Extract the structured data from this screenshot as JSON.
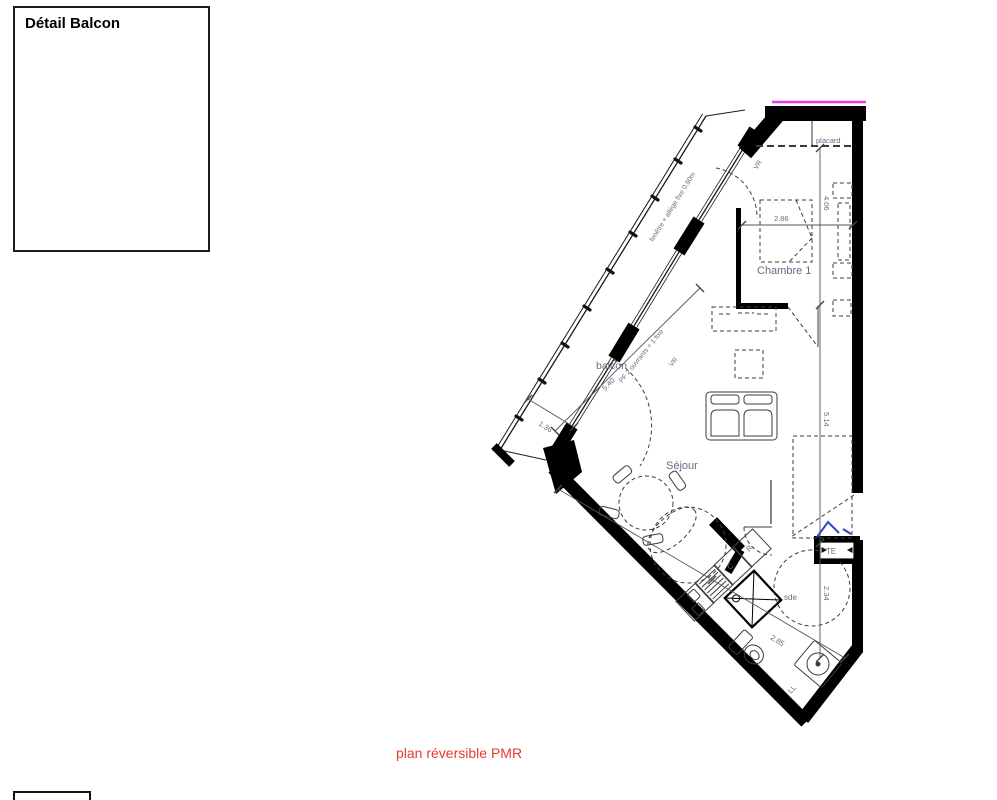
{
  "detail_box": {
    "title": "Détail Balcon"
  },
  "caption": {
    "text": "plan réversible PMR",
    "color": "#e53935"
  },
  "plan": {
    "rooms": {
      "balcony": "balcon",
      "living": "Séjour",
      "bedroom": "Chambre 1",
      "closet": "placard",
      "bathroom": "sde"
    },
    "annotations": {
      "window_note": "fenêtre + allège fixe 0.90m",
      "balcony_door_note": "PF 2 ouvrants + 1 fixe",
      "shutter_top": "VR",
      "shutter_mid": "VR",
      "electrical_panel": "TE",
      "washer": "LL",
      "cooking": "C",
      "fridge": "R"
    },
    "dimensions": {
      "balcony_length": "5.40",
      "balcony_width": "1.36",
      "bedroom_width": "2.86",
      "bedroom_depth": "4.06",
      "hall_length": "5.14",
      "bathroom_width": "2.34",
      "bathroom_diag": "2.85"
    },
    "colors": {
      "wall": "#000000",
      "label": "#5f6e80",
      "accent_blue": "#2f44cf",
      "boundary_magenta": "#e93de9",
      "caption_red": "#e53935"
    }
  }
}
